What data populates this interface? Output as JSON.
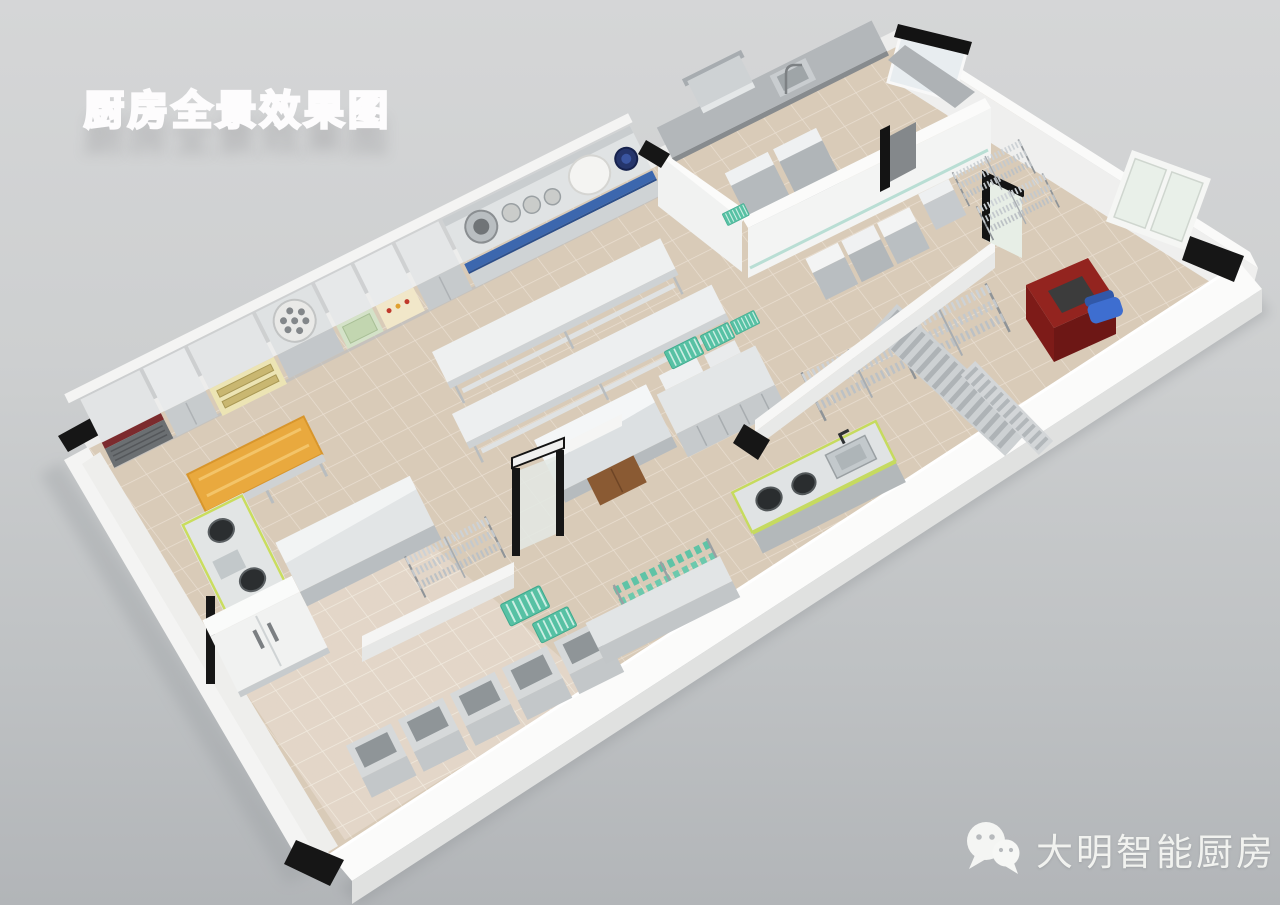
{
  "title": {
    "text": "厨房全景效果图"
  },
  "watermark": {
    "icon": "wechat-icon",
    "text": "大明智能厨房"
  },
  "scene": {
    "type": "3d-commercial-kitchen-panorama-render",
    "colors": {
      "background": "#c8cacc",
      "floor_tile": "#d9cbb8",
      "floor_tile_light": "#e3d7c9",
      "wall_white": "#f7f7f6",
      "wall_cap_black": "#161616",
      "stainless_top": "#e6e8e9",
      "stainless_front": "#c3c7ca",
      "accent_blue_stripe": "#3c67ae",
      "accent_teal_mat": "#57c1a4",
      "accent_green_trim": "#c6db5e",
      "accent_orange_table": "#e9a93e",
      "oven_yellow": "#ece4b4",
      "desk_red": "#93241f",
      "chair_blue": "#3e6ed0",
      "navy_pot": "#25356b"
    }
  }
}
